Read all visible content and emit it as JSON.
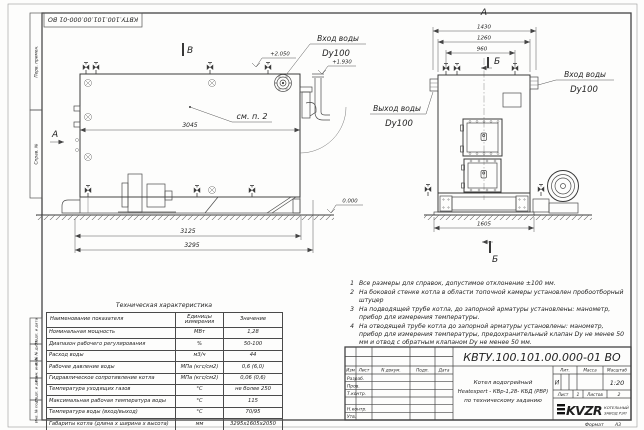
{
  "doc": {
    "designation": "КВТУ.100.101.00.000-01 ВО",
    "stamp_top": "КВТУ.100.101.00.000-01 ВО",
    "format_label": "Формат",
    "format_value": "А3"
  },
  "frame": {
    "left_labels": [
      "Перв. примен.",
      "Справ. №",
      "Подп. и дата",
      "Инв. № дубл.",
      "Взам. инв. №",
      "Подп. и дата",
      "Инв. № подл."
    ]
  },
  "side_view": {
    "section_top": "В",
    "section_left": "А",
    "callout": "см. п. 2",
    "dim_body": "3045",
    "dim_frame": "3125",
    "dim_overall": "3295",
    "elev_inlet": "+2.050",
    "elev_pipe": "+1.930",
    "elev_zero": "0.000",
    "inlet_line1": "Вход воды",
    "inlet_line2": "Dy100"
  },
  "front_view": {
    "section_top": "А",
    "section_b_top": "Б",
    "section_b_bottom": "Б",
    "dim_overall": "1430",
    "dim_body": "1260",
    "dim_valves": "960",
    "dim_base": "1605",
    "inlet_line1": "Вход воды",
    "inlet_line2": "Dy100",
    "outlet_line1": "Выход воды",
    "outlet_line2": "Dy100"
  },
  "notes": [
    {
      "num": "1",
      "text": "Все размеры для справок, допустимое отклонение  ±100 мм."
    },
    {
      "num": "2",
      "text": "На боковой стенке котла в области топочной камеры установлен пробоотборный штуцер"
    },
    {
      "num": "3",
      "text": "На  подводящей трубе котла, до запорной арматуры установлены: манометр, прибор для измерения температуры."
    },
    {
      "num": "4",
      "text": "На отводящей трубе котла до запорной арматуры установлены: манометр, прибор для измерения температуры, предохранительный клапан Dу не менее 50 мм и отвод с обратным клапаном Dу не менее 50 мм."
    }
  ],
  "spec_table": {
    "title": "Техническая характеристика",
    "headers": [
      "Наименование показателя",
      "Единицы измерения",
      "Значение"
    ],
    "rows": [
      {
        "name": "Номинальная мощность",
        "unit": "МВт",
        "value": "1,28"
      },
      {
        "name": "Диапазон рабочего регулирования",
        "unit": "%",
        "value": "50-100"
      },
      {
        "name": "Расход воды",
        "unit": "м3/ч",
        "value": "44"
      },
      {
        "name": "Рабочее давление воды",
        "unit": "МПа (кгс/см2)",
        "value": "0,6 (6,0)"
      },
      {
        "name": "Гидравлическое сопротивление котла",
        "unit": "МПа (кгс/см2)",
        "value": "0,06 (0,6)"
      },
      {
        "name": "Температура уходящих газов",
        "unit": "°С",
        "value": "не более 250"
      },
      {
        "name": "Максимальная рабочая температура воды",
        "unit": "°С",
        "value": "115"
      },
      {
        "name": "Температура воды (вход/выход)",
        "unit": "°С",
        "value": "70/95"
      },
      {
        "name": "Габариты котла (длина х ширина х высота)",
        "unit": "мм",
        "value": "3295х1605х2050"
      }
    ]
  },
  "title_block": {
    "designation": "КВТУ.100.101.00.000-01  ВО",
    "col_headers": {
      "izm": "Изм",
      "list": "Лист",
      "doc": "N докум.",
      "sign": "Подп.",
      "date": "Дата"
    },
    "row_labels": {
      "razrab": "Разраб.",
      "prov": "Пров.",
      "tkontr": "Т.контр.",
      "nkontr": "Н.контр.",
      "utv": "Утв."
    },
    "name_line1": "Котел водогрейный",
    "name_line2": "Heatexpert - КВр-1,28- КБД (РВР)",
    "name_line3": "по техническому заданию",
    "lit_header": "Лит.",
    "lit_value": "И",
    "mass_header": "Масса",
    "scale_header": "Масштаб",
    "scale_value": "1:20",
    "sheet_label": "Лист",
    "sheet_value": "1",
    "sheets_label": "Листов",
    "sheets_value": "2",
    "logo_text": "KVZR",
    "company_line1": "КОТЕЛЬНЫЙ",
    "company_line2": "ЗАВОД РЭП"
  },
  "colors": {
    "line": "#3a3a3a",
    "frame": "#444444",
    "text": "#1f1f1f"
  }
}
